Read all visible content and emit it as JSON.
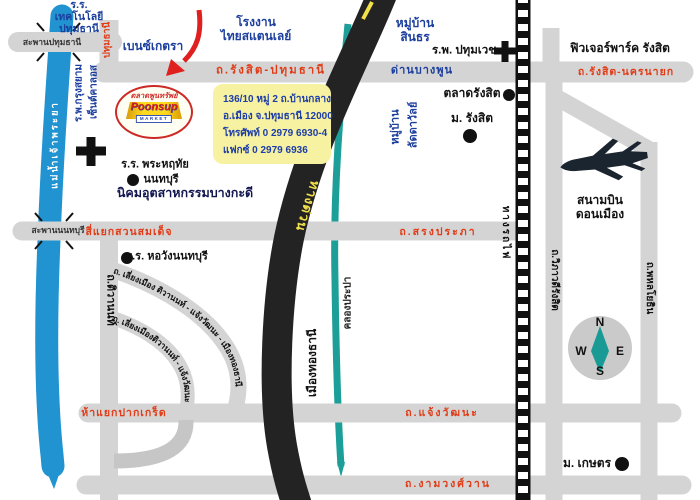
{
  "map": {
    "logo": {
      "thai_name": "ตลาดพูนทรัพย์",
      "brand": "Poonsup",
      "brand_sub": "MARKET"
    },
    "info_box": {
      "address1": "136/10 หมู่ 2 ถ.บ้านกลาง",
      "address2": "อ.เมือง จ.ปทุมธานี 12000",
      "phone": "โทรศัพท์ 0 2979 6930-4",
      "fax": "แฟกซ์ 0 2979 6936"
    },
    "roads": {
      "rangsit_pathumthani": "ถ.รังสิต-ปทุมธานี",
      "rangsit_nakhonnayok": "ถ.รังสิต-นครนายก",
      "pathumthani": "ปทุมธานี",
      "song_prapha": "ถ.สรงประภา",
      "chaengwattana": "ถ.แจ้งวัฒนะ",
      "ngamwongwan": "ถ.งามวงศ์วาน",
      "tiwanon": "ถ.ติวานนท์",
      "vibhavadi_rangsit": "ถ.วิภาวดีรังสิต",
      "phahonyothin": "ถ.พหลโยธิน",
      "bypass_outer": "ถ. เลี่ยงเมือง ติวานนท์ - แจ้งวัฒนะ - เมืองทองธานี",
      "bypass_inner": "ถ. เลี่ยงเมืองติวานนท์ - แจ้งวัฒนะ",
      "tollway": "ทางด่วน",
      "railway": "ทางรถไฟ"
    },
    "junctions": {
      "suan_somdet": "สี่แยกสวนสมเด็จ",
      "pak_kret": "ห้าแยกปากเกร็ด",
      "dan_bang_phun": "ด่านบางพูน"
    },
    "bridges": {
      "pathumthani": "สะพานปทุมธานี",
      "nonthaburi": "สะพานนนทบุรี"
    },
    "water": {
      "chao_phraya": "แม่น้ำเจ้าพระยา",
      "khlong_prapa": "คลองประปา"
    },
    "places": {
      "school_technology": "ร.ร.\nเทคโนโลยี\nปทุมธานี",
      "benz_ketra": "เบนซ์เกตรา",
      "factory_thai_stanley": "โรงงาน\nไทยสแตนเลย์",
      "village_sinthorn": "หมู่บ้าน\nสินธร",
      "hospital_pathumvej": "ร.พ. ปทุมเวช",
      "future_park": "ฟิวเจอร์พาร์ค รังสิต",
      "market_rangsit": "ตลาดรังสิต",
      "university_rangsit": "ม. รังสิต",
      "village_laddawan_line1": "หมู่บ้าน",
      "village_laddawan_line2": "ลัดดาวัลย์",
      "hospital_krungsiam_line1": "ร.พ.กรุงสยาม",
      "hospital_krungsiam_line2": "เซ็นต์คาลอส",
      "school_phraharuethai_line1": "ร.ร. พระหฤทัย",
      "school_phraharuethai_line2": "นนทบุรี",
      "industrial_estate": "นิคมอุตสาหกรรมบางกะดี",
      "school_horwang": "ร.ร. หอวังนนทบุรี",
      "muang_thong_thani": "เมืองทองธานี",
      "airport": "สนามบิน\nดอนเมือง",
      "university_kasetsart": "ม. เกษตร"
    },
    "compass": {
      "n": "N",
      "w": "W",
      "e": "E",
      "s": "S"
    },
    "colors": {
      "road": "#d4d4d4",
      "tollway": "#232323",
      "river": "#2193d1",
      "canal": "#1b9f98",
      "label_red": "#e23c17",
      "label_blue": "#1c3f9e",
      "info_bg": "#f7f2a1",
      "logo_red": "#d42020",
      "needle_teal": "#1a9a94",
      "road_text_yellow": "#f2e14b"
    }
  }
}
